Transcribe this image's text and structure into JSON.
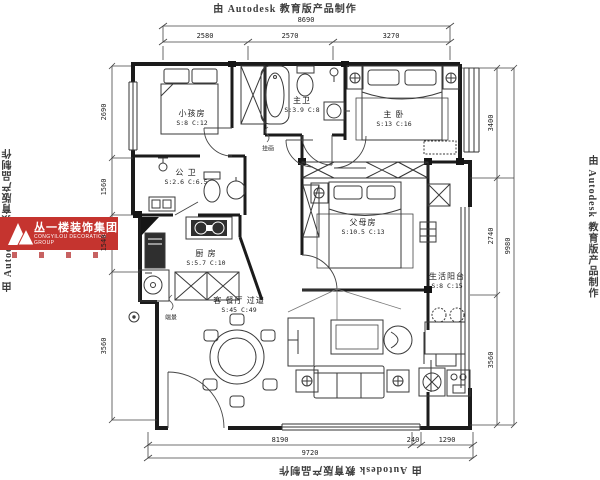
{
  "watermark": {
    "text": "由 Autodesk 教育版产品制作"
  },
  "logo": {
    "company_cn": "丛一楼装饰集团",
    "company_en": "CONGYILOU DECORATION GROUP",
    "brand_color": "#c5342f"
  },
  "rooms": [
    {
      "name": "小孩房",
      "stats": "S:8  C:12"
    },
    {
      "name": "主卫",
      "stats": "S:3.9 C:8"
    },
    {
      "name": "主 卧",
      "stats": "S:13  C:16"
    },
    {
      "name": "公 卫",
      "stats": "S:2.6  C:6.5"
    },
    {
      "name": "厨 房",
      "stats": "S:5.7  C:10"
    },
    {
      "name": "父母房",
      "stats": "S:10.5  C:13"
    },
    {
      "name": "生活阳台",
      "stats": "S:8  C:15"
    },
    {
      "name": "客  餐厅  过道",
      "stats": "S:45  C:49"
    }
  ],
  "annotations": {
    "art": "挂画",
    "feature": "端景"
  },
  "dimensions": {
    "top": {
      "total": "8690",
      "segments": [
        "2580",
        "2570",
        "3270"
      ]
    },
    "left": {
      "segments": [
        "2690",
        "1560",
        "1540",
        "3560"
      ]
    },
    "right": {
      "total": "9980",
      "segments": [
        "3400",
        "2740",
        "3560"
      ]
    },
    "bottom": {
      "total": "9720",
      "segments": [
        "8190",
        "240",
        "1290"
      ]
    }
  }
}
